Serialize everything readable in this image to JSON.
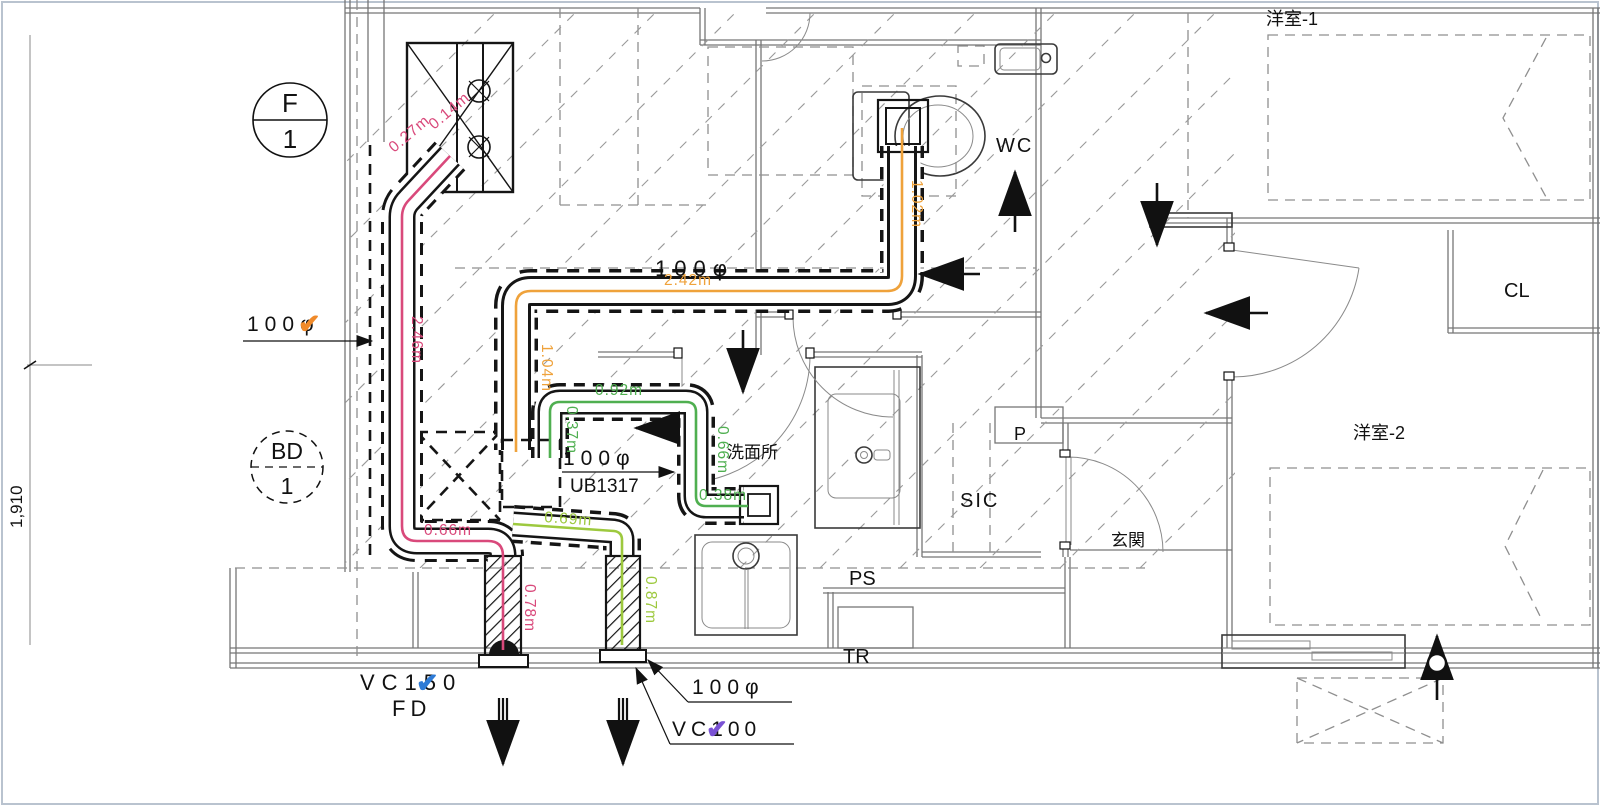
{
  "colors": {
    "pink": "#D9497B",
    "orange": "#EFA23B",
    "green": "#4FAF50",
    "lime": "#9DC93E",
    "check_blue": "#2E7BD6",
    "check_purple": "#7A52D4",
    "check_orange": "#F08A2A",
    "frame": "#B9C3CF"
  },
  "symbols": {
    "fan": {
      "top": "F",
      "bottom": "1"
    },
    "bd": {
      "top": "BD",
      "bottom": "1"
    },
    "check": "✔"
  },
  "dimension": {
    "left": "1,910"
  },
  "pipe_labels": {
    "dia_left": "100φ",
    "dia_top": "100φ",
    "dia_mid": "100φ",
    "dia_bottom": "100φ",
    "vc150": "VC150",
    "fd": "FD",
    "vc100": "VC100",
    "unit_bath": "UB1317"
  },
  "rooms": {
    "wc": "WC",
    "washroom": "洗面所",
    "sic": "SIC",
    "entrance": "玄関",
    "ps": "PS",
    "tr": "TR",
    "pipe_space": "P",
    "closet": "CL",
    "bedroom1": "洋室-1",
    "bedroom2": "洋室-2"
  },
  "measurements": {
    "pink": [
      "0.27m",
      "0.14m",
      "2.46m",
      "0.66m",
      "0.78m"
    ],
    "orange": [
      "1.02m",
      "2.42m",
      "1.04m"
    ],
    "green": [
      "0.92m",
      "0.37m",
      "0.66m",
      "0.38m"
    ],
    "lime": [
      "0.69m",
      "0.87m"
    ]
  }
}
